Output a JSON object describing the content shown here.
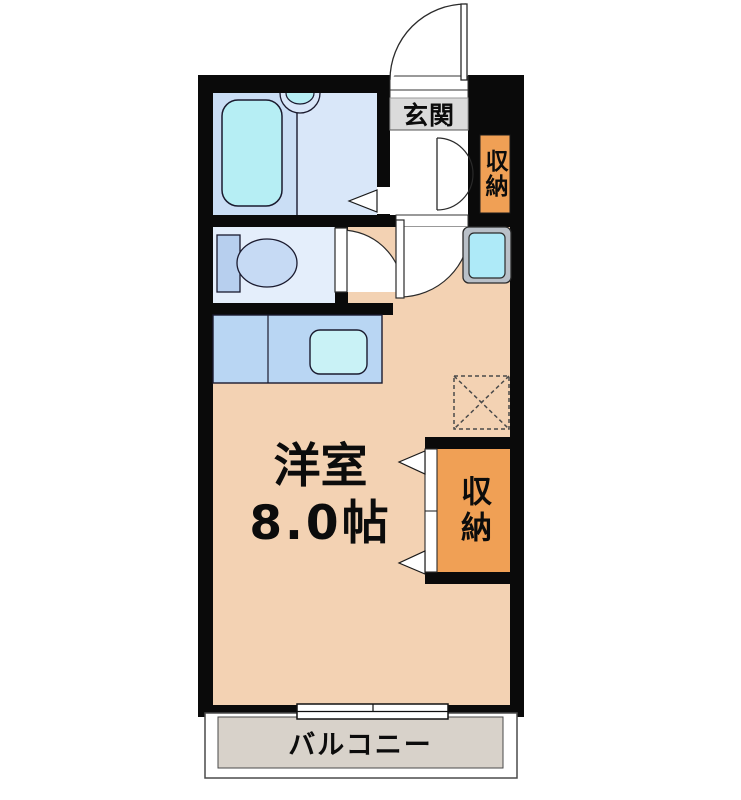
{
  "plan": {
    "entrance_label": "玄関",
    "closet_top_label": "収納",
    "closet_main_label": "収納",
    "main_room_name": "洋室",
    "main_room_size": "8.0帖",
    "balcony_label": "バルコニー",
    "fixtures": [
      "entrance-door",
      "entry-closet-double-door",
      "bathtub",
      "wash-basin",
      "bathroom-folding-door",
      "toilet",
      "washroom-door",
      "kitchen-counter",
      "kitchen-sink",
      "main-room-door",
      "washing-machine-pan",
      "refrigerator-space",
      "closet-folding-door",
      "balcony-sliding-window"
    ],
    "colors": {
      "wall": "#0a0a0a",
      "main_room_floor": "#f3d2b3",
      "bathroom_floor": "#cadef5",
      "washroom_floor": "#d9e7f9",
      "toilet_floor": "#e4eefb",
      "fixture_cyan": "#b6eef4",
      "kitchen_counter": "#b9d6f3",
      "kitchen_sink": "#c9f2f6",
      "closet_orange": "#f0a055",
      "entrance_gray": "#dbdbdb",
      "balcony_gray": "#d8d2ca",
      "washer_pan_gray": "#b9c0c8"
    }
  }
}
